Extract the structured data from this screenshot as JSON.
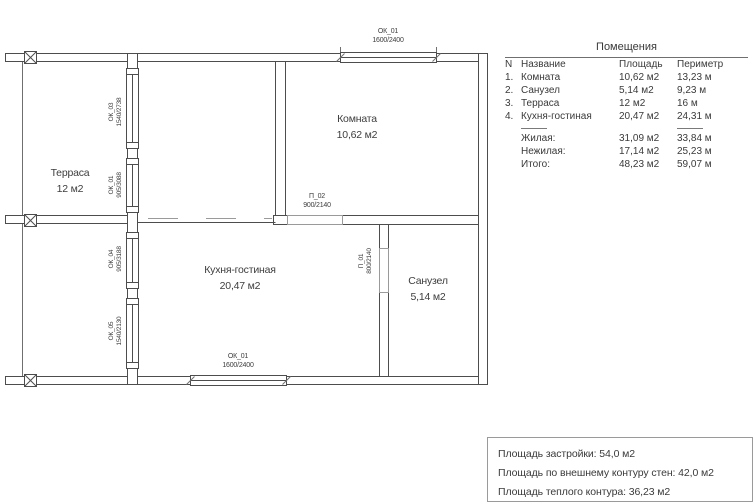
{
  "plan": {
    "room_labels": {
      "terrace": {
        "name": "Терраса",
        "area": "12 м2"
      },
      "room": {
        "name": "Комната",
        "area": "10,62 м2"
      },
      "kitchen": {
        "name": "Кухня-гостиная",
        "area": "20,47 м2"
      },
      "bathroom": {
        "name": "Санузел",
        "area": "5,14 м2"
      }
    },
    "openings": {
      "window_top": {
        "code": "ОК_01",
        "size": "1600/2400"
      },
      "window_bottom": {
        "code": "ОК_01",
        "size": "1600/2400"
      },
      "window_left_1": {
        "code": "ОК_03",
        "size": "1540/2738"
      },
      "window_left_2": {
        "code": "ОК_01",
        "size": "905/3088"
      },
      "window_left_3": {
        "code": "ОК_04",
        "size": "905/3188"
      },
      "window_left_4": {
        "code": "ОК_05",
        "size": "1540/2130"
      },
      "door_main": {
        "code": "П_02",
        "size": "900/2140"
      },
      "door_bath": {
        "code": "П_01",
        "size": "800/2140"
      }
    }
  },
  "rooms_table": {
    "title": "Помещения",
    "headers": {
      "num": "N",
      "name": "Название",
      "area": "Площадь",
      "perimeter": "Периметр"
    },
    "rows": [
      {
        "num": "1.",
        "name": "Комната",
        "area": "10,62 м2",
        "perimeter": "13,23 м"
      },
      {
        "num": "2.",
        "name": "Санузел",
        "area": "5,14 м2",
        "perimeter": "9,23 м"
      },
      {
        "num": "3.",
        "name": "Терраса",
        "area": "12 м2",
        "perimeter": "16 м"
      },
      {
        "num": "4.",
        "name": "Кухня-гостиная",
        "area": "20,47 м2",
        "perimeter": "24,31 м"
      }
    ],
    "totals": [
      {
        "name": "Жилая:",
        "area": "31,09 м2",
        "perimeter": "33,84 м"
      },
      {
        "name": "Нежилая:",
        "area": "17,14 м2",
        "perimeter": "25,23 м"
      },
      {
        "name": "Итого:",
        "area": "48,23 м2",
        "perimeter": "59,07 м"
      }
    ]
  },
  "summary": {
    "lines": [
      "Площадь застройки: 54,0 м2",
      "Площадь по внешнему контуру стен: 42,0 м2",
      "Площадь теплого контура: 36,23 м2"
    ]
  },
  "colors": {
    "wall_line": "#4d4d4d",
    "thin_line": "#8c8c8c",
    "text": "#3a3a3a"
  }
}
